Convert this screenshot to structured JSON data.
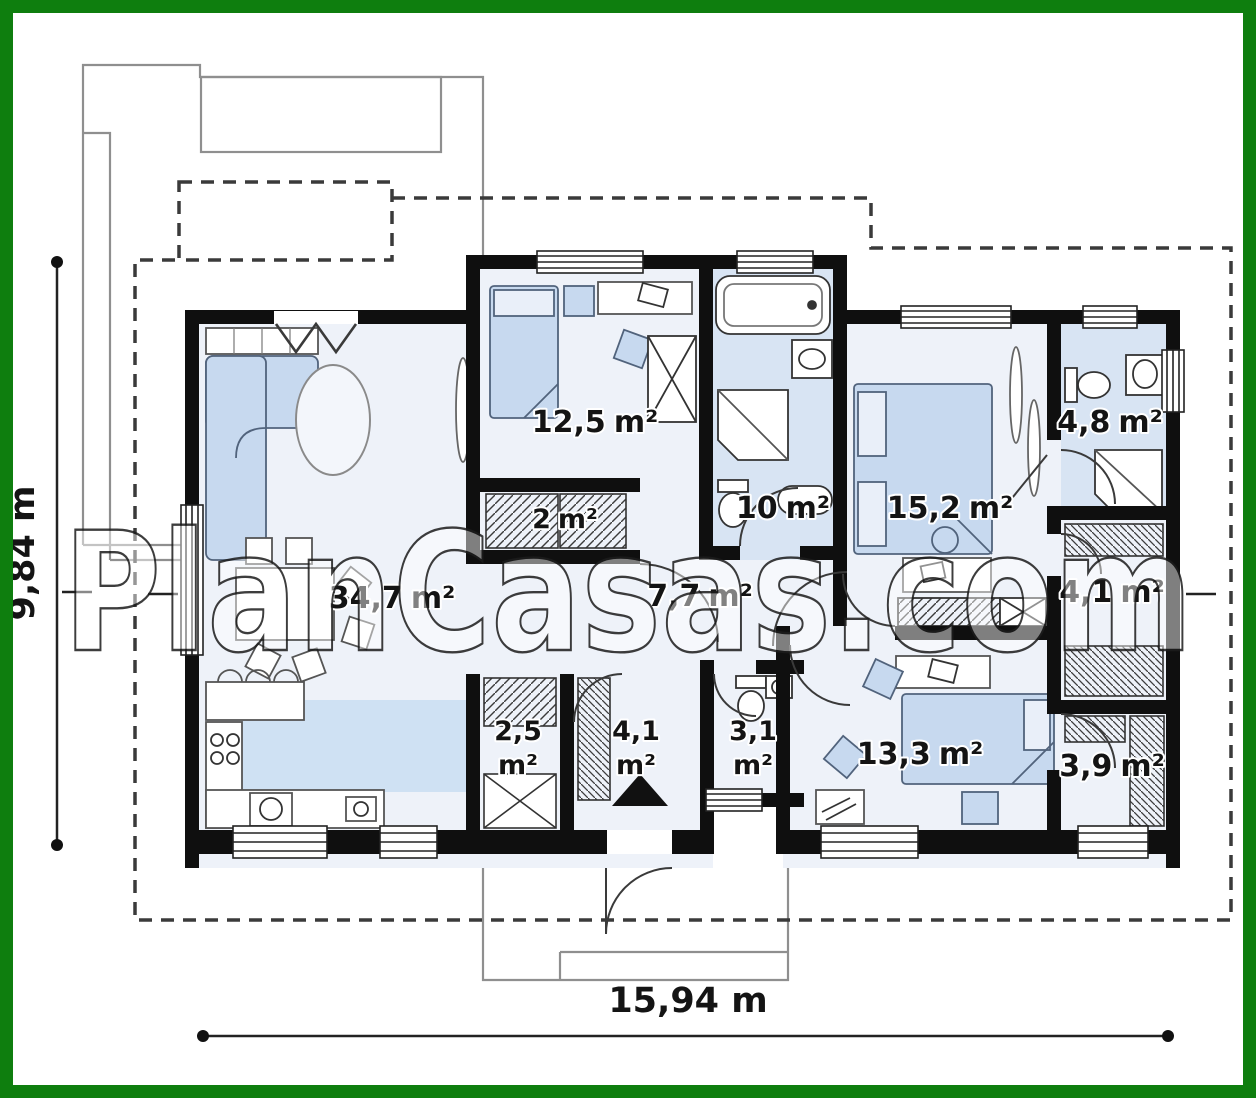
{
  "watermark": {
    "text": "PlanCasas.com"
  },
  "dimensions": {
    "width_label": "15,94 m",
    "height_label": "9,84 m"
  },
  "rooms": [
    {
      "name": "living-dining-kitchen",
      "value": "34,7",
      "unit": "m²"
    },
    {
      "name": "bedroom-1",
      "value": "12,5",
      "unit": "m²"
    },
    {
      "name": "hall-closet",
      "value": "2",
      "unit": "m²"
    },
    {
      "name": "bathroom",
      "value": "10",
      "unit": "m²"
    },
    {
      "name": "master-bedroom",
      "value": "15,2",
      "unit": "m²"
    },
    {
      "name": "ensuite-bathroom",
      "value": "4,8",
      "unit": "m²"
    },
    {
      "name": "hall",
      "value": "7,7",
      "unit": "m²"
    },
    {
      "name": "wardrobe-right",
      "value": "4,1",
      "unit": "m²"
    },
    {
      "name": "pantry",
      "value": "2,5",
      "unit": "m²"
    },
    {
      "name": "entry",
      "value": "4,1",
      "unit": "m²"
    },
    {
      "name": "wc",
      "value": "3,1",
      "unit": "m²"
    },
    {
      "name": "bedroom-2",
      "value": "13,3",
      "unit": "m²"
    },
    {
      "name": "wardrobe-2",
      "value": "3,9",
      "unit": "m²"
    }
  ],
  "colors": {
    "frame_green": "#0e7e0e",
    "wall_black": "#0f0f0f",
    "floor": "#eef2f9",
    "bath_floor": "#d8e4f3",
    "kitchen_floor": "#cfe1f3",
    "furniture_blue": "#c7d9ef"
  }
}
